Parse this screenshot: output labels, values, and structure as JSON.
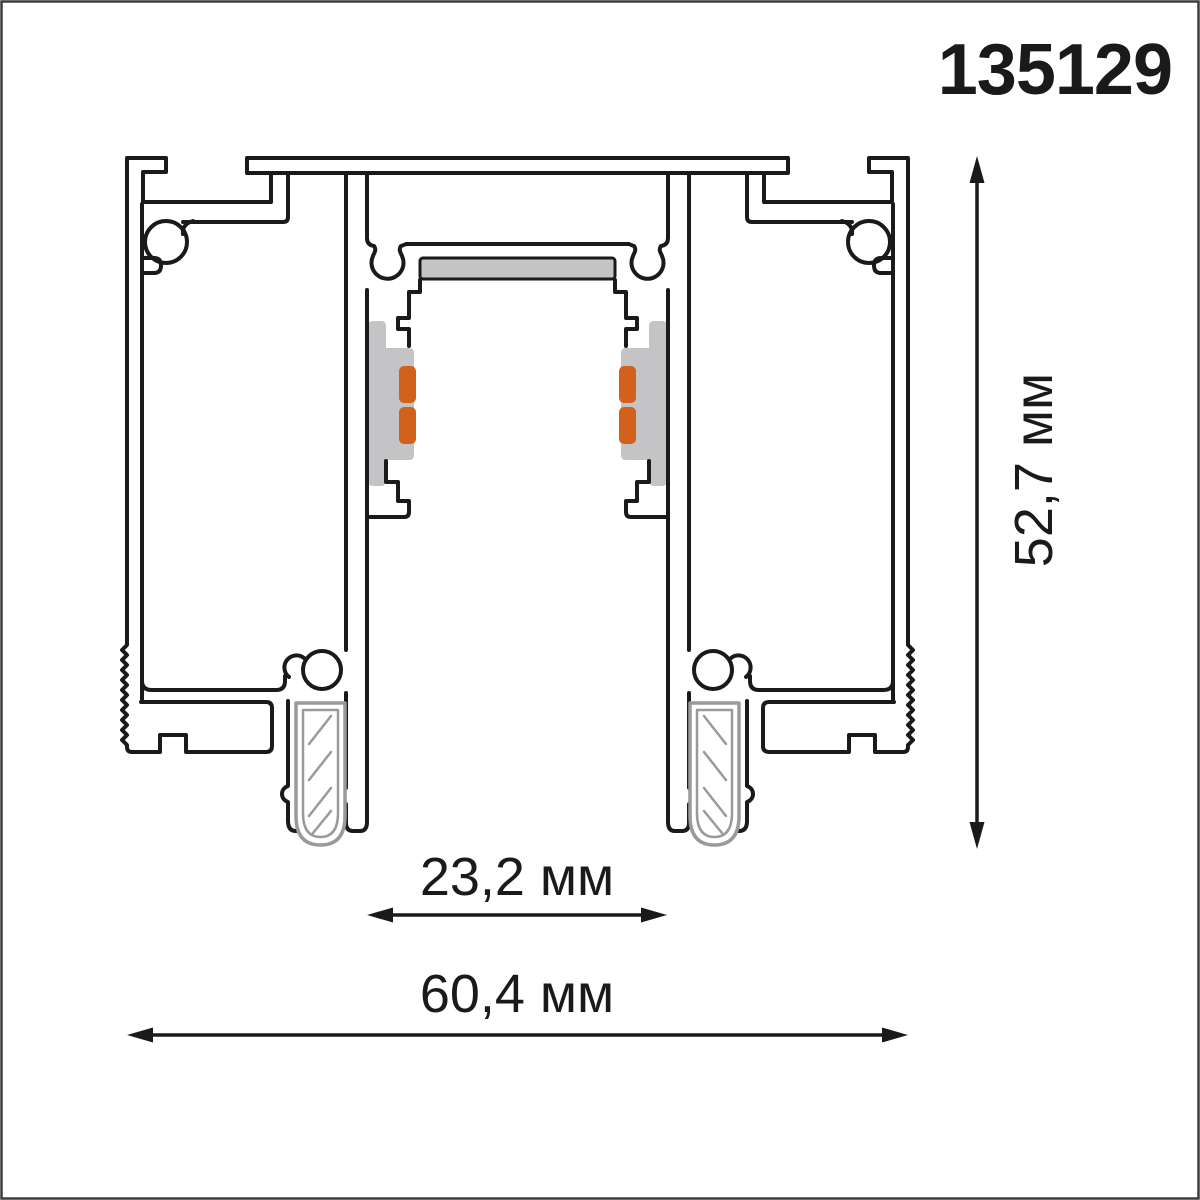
{
  "page": {
    "title": "Track profile cross-section drawing"
  },
  "product": {
    "code": "135129"
  },
  "dimensions": {
    "height": {
      "value": "52,7",
      "unit": "мм",
      "label": "52,7 мм"
    },
    "inner_width": {
      "value": "23,2",
      "unit": "мм",
      "label": "23,2 мм"
    },
    "outer_width": {
      "value": "60,4",
      "unit": "мм",
      "label": "60,4 мм"
    }
  },
  "colors": {
    "line": "#1a1a1a",
    "insulator_gray": "#c4c4c6",
    "contact_orange": "#d2611c",
    "clip_gray": "#9a9a9a",
    "border": "#3c3c3c"
  }
}
